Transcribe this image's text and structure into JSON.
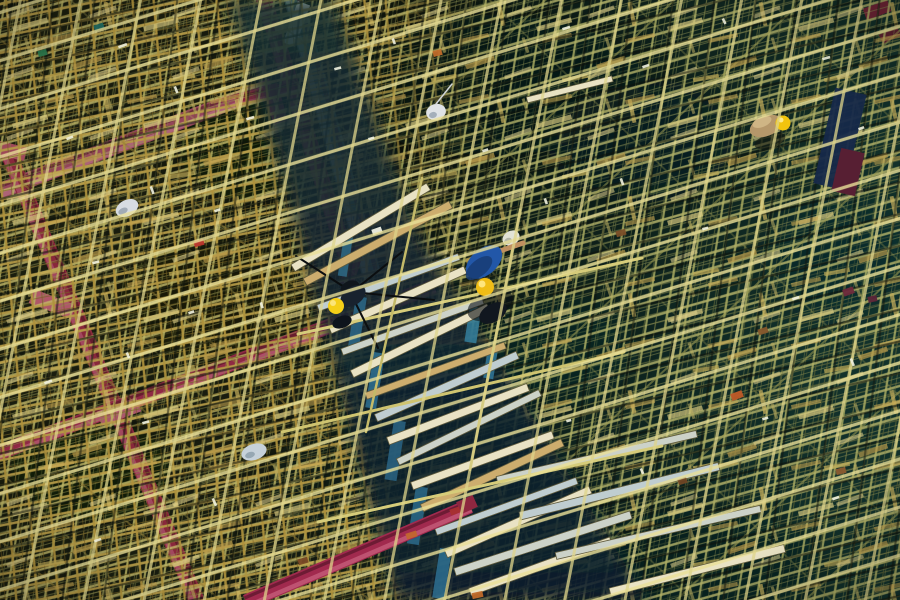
{
  "scene": {
    "title": "Aerial photograph: workers on dense bamboo and steel scaffolding",
    "description": "Top-down aerial photo of a construction site covered in a dense criss-cross lattice of golden bamboo and pale steel scaffolding poles, crossed by crimson structural beams on the left, a diagonal plank walkway down the center, and three workers wearing yellow hard hats",
    "width": 900,
    "height": 600,
    "workers_count": 3
  },
  "palette": {
    "bg_olive": "#141a0f",
    "bg_teal": "#13302a",
    "pole_gold": "#c2a64e",
    "pole_pale": "#cfc773",
    "pole_bright": "#eae098",
    "beam_red": "#8e2740",
    "beam_red_light": "#b05070",
    "beam_mauve": "#9a4462",
    "steel_teal": "#4f6e6a",
    "steel_teal_light": "#9cb2a8",
    "plank_cream": "#e9e2c4",
    "plank_tan": "#cdad6e",
    "plank_blue": "#bfcdd0",
    "plank_silver": "#ccd2c8",
    "helmet_yellow": "#f0bd16",
    "shirt_blue": "#2257a8",
    "tarp_navy": "#16294a",
    "bag_white": "#d7dce2",
    "band_teal": "#2e6a86",
    "glint_white": "#f1f2e0"
  },
  "objects": {
    "red_beams_back": [
      {
        "name": "beam-a",
        "x1": 0,
        "y1": 191,
        "x2": 272,
        "y2": 86,
        "w": 16,
        "c": "beam_mauve",
        "l": "#bb6e88"
      },
      {
        "name": "beam-b",
        "x1": 6,
        "y1": 148,
        "x2": 198,
        "y2": 604,
        "w": 16,
        "c": "#8e2540",
        "l": "#b05070"
      },
      {
        "name": "beam-c",
        "x1": -4,
        "y1": 454,
        "x2": 434,
        "y2": 286,
        "w": 15,
        "c": "#96264a",
        "l": "#bb5a78"
      },
      {
        "name": "beam-e",
        "x1": 262,
        "y1": -6,
        "x2": 346,
        "y2": 256,
        "w": 16,
        "c": "#7e2236",
        "l": "#a04456"
      },
      {
        "name": "steel-channel",
        "x1": 292,
        "y1": -6,
        "x2": 372,
        "y2": 276,
        "w": 19,
        "c": "steel_teal",
        "l": "steel_teal_light"
      },
      {
        "name": "beam-bracket",
        "x1": 236,
        "y1": 101,
        "x2": 292,
        "y2": 88,
        "w": 13,
        "c": "beam_red",
        "l": "#aa4a60"
      }
    ],
    "plates_back": [
      {
        "name": "beam-a-end",
        "x": 268,
        "y": 84,
        "w": 15,
        "h": 40,
        "rot": -16,
        "c": "#7e2a42"
      },
      {
        "name": "beam-b-top-plate",
        "x": -2,
        "y": 144,
        "w": 28,
        "h": 14,
        "rot": 14,
        "c": "#a84a62"
      },
      {
        "name": "beam-b-plate",
        "x": 30,
        "y": 296,
        "w": 42,
        "h": 15,
        "rot": 21,
        "c": "#b85a72"
      },
      {
        "name": "beam-junction-plate",
        "x": 98,
        "y": 404,
        "w": 42,
        "h": 15,
        "rot": -20,
        "c": "#b45a74"
      },
      {
        "name": "channel-cap",
        "x": 290,
        "y": 2,
        "w": 13,
        "h": 44,
        "rot": 20,
        "c": "#dde2d8"
      },
      {
        "name": "beam-e-lower",
        "x": 346,
        "y": 240,
        "w": 14,
        "h": 46,
        "rot": 17,
        "c": "#7e2236"
      },
      {
        "name": "corner-red-1",
        "x": 864,
        "y": 4,
        "w": 26,
        "h": 12,
        "rot": -20,
        "c": "#7e2236"
      },
      {
        "name": "corner-red-2",
        "x": 880,
        "y": 30,
        "w": 20,
        "h": 10,
        "rot": -26,
        "c": "#681c2e"
      }
    ],
    "band_slivers": [
      {
        "x": 344,
        "y": 236,
        "w": 9,
        "h": 40,
        "c": "#2e6a86"
      },
      {
        "x": 356,
        "y": 296,
        "w": 11,
        "h": 52,
        "c": "#2c6888"
      },
      {
        "x": 374,
        "y": 352,
        "w": 11,
        "h": 56,
        "c": "#2e7092"
      },
      {
        "x": 394,
        "y": 420,
        "w": 12,
        "h": 60,
        "c": "#2a6484"
      },
      {
        "x": 416,
        "y": 486,
        "w": 12,
        "h": 58,
        "c": "#2c6a8a"
      },
      {
        "x": 440,
        "y": 548,
        "w": 12,
        "h": 50,
        "c": "#2e7092"
      },
      {
        "x": 470,
        "y": 306,
        "w": 12,
        "h": 36,
        "c": "#35809e"
      },
      {
        "x": 488,
        "y": 348,
        "w": 10,
        "h": 30,
        "c": "#30789a"
      }
    ],
    "planks": [
      {
        "x": 293,
        "y": 268,
        "len": 158,
        "w": 8,
        "rot": -31,
        "c": "plank_cream"
      },
      {
        "x": 305,
        "y": 282,
        "len": 165,
        "w": 8,
        "rot": -28,
        "c": "plank_tan"
      },
      {
        "x": 318,
        "y": 308,
        "len": 150,
        "w": 7,
        "rot": -20,
        "c": "plank_blue"
      },
      {
        "x": 330,
        "y": 330,
        "len": 148,
        "w": 8,
        "rot": -24,
        "c": "plank_cream"
      },
      {
        "x": 342,
        "y": 352,
        "len": 150,
        "w": 7,
        "rot": -20,
        "c": "plank_silver"
      },
      {
        "x": 352,
        "y": 374,
        "len": 152,
        "w": 8,
        "rot": -26,
        "c": "plank_cream"
      },
      {
        "x": 366,
        "y": 396,
        "len": 148,
        "w": 7,
        "rot": -20,
        "c": "plank_tan"
      },
      {
        "x": 376,
        "y": 418,
        "len": 155,
        "w": 8,
        "rot": -24,
        "c": "plank_blue"
      },
      {
        "x": 388,
        "y": 441,
        "len": 150,
        "w": 8,
        "rot": -21,
        "c": "plank_cream"
      },
      {
        "x": 398,
        "y": 462,
        "len": 158,
        "w": 7,
        "rot": -26,
        "c": "plank_silver"
      },
      {
        "x": 412,
        "y": 486,
        "len": 150,
        "w": 8,
        "rot": -20,
        "c": "plank_cream"
      },
      {
        "x": 422,
        "y": 508,
        "len": 155,
        "w": 8,
        "rot": -25,
        "c": "plank_tan"
      },
      {
        "x": 436,
        "y": 532,
        "len": 150,
        "w": 7,
        "rot": -20,
        "c": "plank_blue"
      },
      {
        "x": 446,
        "y": 554,
        "len": 158,
        "w": 8,
        "rot": -24,
        "c": "plank_cream"
      },
      {
        "x": 455,
        "y": 572,
        "len": 185,
        "w": 8,
        "rot": -18,
        "c": "plank_silver"
      },
      {
        "x": 470,
        "y": 592,
        "len": 150,
        "w": 8,
        "rot": -20,
        "c": "plank_cream"
      },
      {
        "x": 497,
        "y": 480,
        "len": 205,
        "w": 7,
        "rot": -13,
        "c": "plank_silver"
      },
      {
        "x": 520,
        "y": 516,
        "len": 205,
        "w": 8,
        "rot": -14,
        "c": "plank_blue"
      },
      {
        "x": 556,
        "y": 556,
        "len": 210,
        "w": 7,
        "rot": -13,
        "c": "plank_silver"
      },
      {
        "x": 610,
        "y": 592,
        "len": 180,
        "w": 8,
        "rot": -14,
        "c": "plank_cream"
      },
      {
        "x": 527,
        "y": 100,
        "len": 88,
        "w": 6,
        "rot": -14,
        "c": "plank_cream"
      }
    ],
    "red_beams_front": [
      {
        "name": "beam-f",
        "x1": 246,
        "y1": 602,
        "x2": 470,
        "y2": 506,
        "w": 15,
        "c": "#a12a4e",
        "l": "#c45a78"
      }
    ],
    "plates_front": [
      {
        "name": "beam-f-tip",
        "x": 458,
        "y": 498,
        "w": 18,
        "h": 13,
        "rot": -24,
        "c": "beam_red"
      }
    ],
    "debris": [
      {
        "x": 194,
        "y": 240,
        "w": 10,
        "h": 6,
        "rot": -15,
        "c": "#b8342c"
      },
      {
        "x": 731,
        "y": 392,
        "w": 12,
        "h": 7,
        "rot": -20,
        "c": "#bf5a28"
      },
      {
        "x": 406,
        "y": 532,
        "w": 11,
        "h": 6,
        "rot": -18,
        "c": "#c2662e"
      },
      {
        "x": 450,
        "y": 508,
        "w": 10,
        "h": 6,
        "rot": -20,
        "c": "#a83030"
      },
      {
        "x": 472,
        "y": 592,
        "w": 11,
        "h": 6,
        "rot": -12,
        "c": "#c06a2a"
      },
      {
        "x": 433,
        "y": 50,
        "w": 9,
        "h": 6,
        "rot": -15,
        "c": "#c06a2a"
      },
      {
        "x": 94,
        "y": 24,
        "w": 10,
        "h": 6,
        "rot": -18,
        "c": "#1f6a62"
      },
      {
        "x": 38,
        "y": 50,
        "w": 9,
        "h": 6,
        "rot": -15,
        "c": "#2a7a4e"
      },
      {
        "x": 616,
        "y": 230,
        "w": 10,
        "h": 6,
        "rot": -16,
        "c": "#7a4e28"
      },
      {
        "x": 758,
        "y": 328,
        "w": 10,
        "h": 6,
        "rot": -18,
        "c": "#84562c"
      },
      {
        "x": 836,
        "y": 468,
        "w": 10,
        "h": 6,
        "rot": -14,
        "c": "#8a5a30"
      },
      {
        "x": 298,
        "y": 558,
        "w": 10,
        "h": 6,
        "rot": -16,
        "c": "#7a4a26"
      },
      {
        "x": 678,
        "y": 478,
        "w": 9,
        "h": 6,
        "rot": -18,
        "c": "#6e4424"
      },
      {
        "x": 843,
        "y": 288,
        "w": 11,
        "h": 7,
        "rot": -20,
        "c": "#6e2a3c"
      },
      {
        "x": 868,
        "y": 296,
        "w": 9,
        "h": 6,
        "rot": -12,
        "c": "#5a2438"
      }
    ],
    "figures": [
      {
        "t": "line",
        "x1": 298,
        "y1": 334,
        "x2": 642,
        "y2": 258,
        "sw": 3,
        "c": "#d6cc7a",
        "name": "loose-rail"
      },
      {
        "t": "line",
        "x1": 282,
        "y1": 432,
        "x2": 624,
        "y2": 352,
        "sw": 3,
        "c": "#cfc470",
        "name": "loose-rail"
      },
      {
        "t": "line",
        "x1": 318,
        "y1": 522,
        "x2": 662,
        "y2": 446,
        "sw": 3,
        "c": "#d6cc7a",
        "name": "loose-rail"
      },
      {
        "t": "line",
        "x1": 422,
        "y1": 178,
        "x2": 366,
        "y2": 432,
        "sw": 2.5,
        "c": "#c4ba68",
        "name": "loose-rail-steep"
      },
      {
        "t": "line",
        "x1": 520,
        "y1": 210,
        "x2": 470,
        "y2": 470,
        "sw": 2.5,
        "c": "#bcb262",
        "name": "loose-rail-steep"
      },
      {
        "t": "line",
        "x1": 352,
        "y1": 292,
        "x2": 296,
        "y2": 256,
        "sw": 2,
        "c": "#0b0e10",
        "name": "hoist-rope"
      },
      {
        "t": "line",
        "x1": 352,
        "y1": 292,
        "x2": 402,
        "y2": 252,
        "sw": 2,
        "c": "#0b0e10",
        "name": "hoist-rope"
      },
      {
        "t": "line",
        "x1": 352,
        "y1": 292,
        "x2": 434,
        "y2": 300,
        "sw": 2,
        "c": "#0b0e10",
        "name": "hoist-rope"
      },
      {
        "t": "line",
        "x1": 350,
        "y1": 292,
        "x2": 378,
        "y2": 348,
        "sw": 2,
        "c": "#0b0e10",
        "name": "hoist-rope"
      },
      {
        "t": "ellipse",
        "cx": 350,
        "cy": 288,
        "rx": 10,
        "ry": 7,
        "rot": -25,
        "c": "#10161c",
        "name": "pulley-block"
      },
      {
        "t": "ellipse",
        "cx": 353,
        "cy": 296,
        "rx": 14,
        "ry": 9,
        "rot": -35,
        "c": "#18222e",
        "name": "worker2-body"
      },
      {
        "t": "ellipse",
        "cx": 342,
        "cy": 322,
        "rx": 10,
        "ry": 6,
        "rot": -20,
        "c": "#0e141c",
        "name": "worker2-legs"
      },
      {
        "t": "circle",
        "cx": 336,
        "cy": 306,
        "r": 8,
        "c": "#f5cf18",
        "name": "worker2-helmet"
      },
      {
        "t": "circle",
        "cx": 333,
        "cy": 303,
        "r": 3,
        "c": "#fce98c",
        "o": 0.85,
        "name": "worker2-helmet-shine"
      },
      {
        "t": "ellipse",
        "cx": 490,
        "cy": 305,
        "rx": 24,
        "ry": 14,
        "rot": -25,
        "c": "#0a0f14",
        "o": 0.6,
        "name": "worker1-shadow"
      },
      {
        "t": "ellipse",
        "cx": 511,
        "cy": 238,
        "rx": 9,
        "ry": 7,
        "rot": -30,
        "c": "#e2e3d6",
        "name": "white-sack"
      },
      {
        "t": "ellipse",
        "cx": 508,
        "cy": 241,
        "rx": 4,
        "ry": 3,
        "rot": -30,
        "c": "#a8aa9c",
        "o": 0.8,
        "name": "white-sack-fold"
      },
      {
        "t": "line",
        "x1": 497,
        "y1": 252,
        "x2": 523,
        "y2": 243,
        "sw": 5,
        "c": "#c09060",
        "name": "worker1-arm"
      },
      {
        "t": "ellipse",
        "cx": 484,
        "cy": 262,
        "rx": 21,
        "ry": 13,
        "rot": -40,
        "c": "shirt_blue",
        "name": "worker1-torso"
      },
      {
        "t": "ellipse",
        "cx": 479,
        "cy": 268,
        "rx": 16,
        "ry": 8,
        "rot": -40,
        "c": "#173c74",
        "o": 0.85,
        "name": "worker1-torso-shade"
      },
      {
        "t": "ellipse",
        "cx": 493,
        "cy": 313,
        "rx": 15,
        "ry": 9,
        "rot": -30,
        "c": "#11171f",
        "name": "worker1-legs"
      },
      {
        "t": "circle",
        "cx": 485,
        "cy": 287,
        "r": 9,
        "c": "helmet_yellow",
        "name": "worker1-helmet"
      },
      {
        "t": "circle",
        "cx": 482,
        "cy": 284,
        "r": 3.5,
        "c": "#ffe98a",
        "o": 0.9,
        "name": "worker1-helmet-shine"
      },
      {
        "t": "ellipse",
        "cx": 770,
        "cy": 141,
        "rx": 16,
        "ry": 7,
        "rot": -18,
        "c": "#141810",
        "o": 0.6,
        "name": "worker3-shadow"
      },
      {
        "t": "ellipse",
        "cx": 766,
        "cy": 126,
        "rx": 17,
        "ry": 10,
        "rot": -22,
        "c": "#b5976a",
        "name": "worker3-body"
      },
      {
        "t": "ellipse",
        "cx": 762,
        "cy": 122,
        "rx": 10,
        "ry": 5,
        "rot": -22,
        "c": "#d2b888",
        "o": 0.9,
        "name": "worker3-body-highlight"
      },
      {
        "t": "circle",
        "cx": 783,
        "cy": 123,
        "r": 7.5,
        "c": "#f2c40e",
        "name": "worker3-helmet"
      },
      {
        "t": "circle",
        "cx": 781,
        "cy": 120,
        "r": 2.5,
        "c": "#ffee9a",
        "o": 0.9,
        "name": "worker3-helmet-shine"
      },
      {
        "t": "rect",
        "x": 824,
        "y": 90,
        "w": 32,
        "h": 98,
        "rot": 13,
        "c": "tarp_navy",
        "o": 0.95,
        "name": "blue-tarp"
      },
      {
        "t": "rect",
        "x": 836,
        "y": 150,
        "w": 24,
        "h": 44,
        "rot": 13,
        "c": "#571f33",
        "name": "maroon-cloth"
      },
      {
        "t": "ellipse",
        "cx": 127,
        "cy": 208,
        "rx": 12,
        "ry": 8,
        "rot": -28,
        "c": "bag_white",
        "name": "plastic-bag-1"
      },
      {
        "t": "ellipse",
        "cx": 123,
        "cy": 211,
        "rx": 5,
        "ry": 3,
        "rot": -28,
        "c": "#98a2ae",
        "o": 0.85,
        "name": "plastic-bag-1-fold"
      },
      {
        "t": "ellipse",
        "cx": 254,
        "cy": 452,
        "rx": 13,
        "ry": 8,
        "rot": -18,
        "c": "#c6d1da",
        "name": "plastic-bag-2"
      },
      {
        "t": "ellipse",
        "cx": 250,
        "cy": 455,
        "rx": 5,
        "ry": 3,
        "rot": -18,
        "c": "#8da0ac",
        "o": 0.85,
        "name": "plastic-bag-2-fold"
      },
      {
        "t": "ellipse",
        "cx": 436,
        "cy": 112,
        "rx": 10,
        "ry": 8,
        "rot": -15,
        "c": "#dfe3e6",
        "name": "plastic-bag-3"
      },
      {
        "t": "ellipse",
        "cx": 433,
        "cy": 115,
        "rx": 4,
        "ry": 3,
        "rot": -15,
        "c": "#9aa6b2",
        "o": 0.85,
        "name": "plastic-bag-3-fold"
      },
      {
        "t": "line",
        "x1": 436,
        "y1": 104,
        "x2": 452,
        "y2": 84,
        "sw": 1.5,
        "c": "#cfd4d8",
        "name": "bag-string"
      },
      {
        "t": "rect",
        "x": 372,
        "y": 228,
        "w": 10,
        "h": 6,
        "rot": -20,
        "c": "#e4e6da",
        "name": "white-tape"
      }
    ],
    "glints": [
      {
        "x": 118,
        "y": 46,
        "len": 9,
        "rot": -20
      },
      {
        "x": 176,
        "y": 86,
        "len": 7,
        "rot": 68
      },
      {
        "x": 246,
        "y": 118,
        "len": 8,
        "rot": -16
      },
      {
        "x": 66,
        "y": 138,
        "len": 7,
        "rot": -22
      },
      {
        "x": 152,
        "y": 186,
        "len": 8,
        "rot": 70
      },
      {
        "x": 214,
        "y": 210,
        "len": 6,
        "rot": -18
      },
      {
        "x": 92,
        "y": 262,
        "len": 7,
        "rot": -15
      },
      {
        "x": 262,
        "y": 302,
        "len": 6,
        "rot": 72
      },
      {
        "x": 44,
        "y": 382,
        "len": 8,
        "rot": -20
      },
      {
        "x": 142,
        "y": 422,
        "len": 7,
        "rot": -16
      },
      {
        "x": 214,
        "y": 498,
        "len": 8,
        "rot": 66
      },
      {
        "x": 94,
        "y": 540,
        "len": 7,
        "rot": -18
      },
      {
        "x": 334,
        "y": 68,
        "len": 7,
        "rot": -15
      },
      {
        "x": 394,
        "y": 38,
        "len": 6,
        "rot": 70
      },
      {
        "x": 562,
        "y": 28,
        "len": 8,
        "rot": -17
      },
      {
        "x": 642,
        "y": 66,
        "len": 7,
        "rot": -19
      },
      {
        "x": 724,
        "y": 18,
        "len": 6,
        "rot": 64
      },
      {
        "x": 822,
        "y": 58,
        "len": 8,
        "rot": -16
      },
      {
        "x": 858,
        "y": 128,
        "len": 6,
        "rot": -20
      },
      {
        "x": 622,
        "y": 178,
        "len": 7,
        "rot": 70
      },
      {
        "x": 702,
        "y": 228,
        "len": 6,
        "rot": -15
      },
      {
        "x": 792,
        "y": 298,
        "len": 7,
        "rot": -18
      },
      {
        "x": 852,
        "y": 358,
        "len": 8,
        "rot": 68
      },
      {
        "x": 762,
        "y": 418,
        "len": 6,
        "rot": -16
      },
      {
        "x": 832,
        "y": 498,
        "len": 7,
        "rot": -19
      },
      {
        "x": 642,
        "y": 468,
        "len": 6,
        "rot": 66
      },
      {
        "x": 566,
        "y": 420,
        "len": 5,
        "rot": -15
      },
      {
        "x": 482,
        "y": 150,
        "len": 6,
        "rot": -18
      },
      {
        "x": 546,
        "y": 198,
        "len": 6,
        "rot": 70
      },
      {
        "x": 368,
        "y": 138,
        "len": 6,
        "rot": -16
      },
      {
        "x": 188,
        "y": 312,
        "len": 6,
        "rot": -18
      },
      {
        "x": 128,
        "y": 352,
        "len": 6,
        "rot": 68
      }
    ]
  }
}
